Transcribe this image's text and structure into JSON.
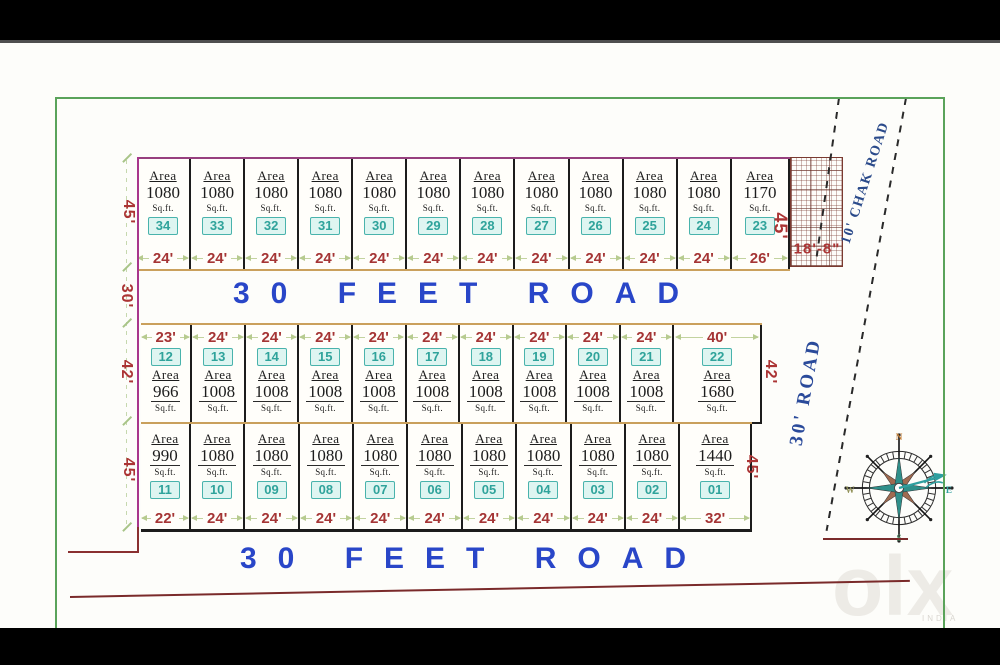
{
  "labels": {
    "area_word": "Area",
    "unit_word": "Sq.ft."
  },
  "roads": {
    "top": "30 FEET ROAD",
    "bottom": "30 FEET ROAD",
    "chak": "10' CHAK ROAD",
    "side": "30' ROAD"
  },
  "dims": {
    "left_top": "45'",
    "left_road": "30'",
    "left_mid": "42'",
    "left_bottom": "45'",
    "right_top": "45'",
    "right_mid": "42'",
    "right_bottom": "45'",
    "hatch_width": "18'-8\""
  },
  "compass": {
    "points": [
      "N",
      "E",
      "S",
      "W"
    ]
  },
  "watermark": {
    "text": "olx",
    "sub": "INDIA"
  },
  "colors": {
    "road_text": "#2946c8",
    "dimension_text": "#ab3434",
    "badge_teal": "#2fa39b",
    "boundary_green": "#5aa35a",
    "boundary_magenta": "#a8368c",
    "row_edge_tan": "#caa05c"
  },
  "rows": {
    "top": {
      "plots": [
        {
          "num": "34",
          "area": "1080",
          "width": "24'",
          "width_ft": 24
        },
        {
          "num": "33",
          "area": "1080",
          "width": "24'",
          "width_ft": 24
        },
        {
          "num": "32",
          "area": "1080",
          "width": "24'",
          "width_ft": 24
        },
        {
          "num": "31",
          "area": "1080",
          "width": "24'",
          "width_ft": 24
        },
        {
          "num": "30",
          "area": "1080",
          "width": "24'",
          "width_ft": 24
        },
        {
          "num": "29",
          "area": "1080",
          "width": "24'",
          "width_ft": 24
        },
        {
          "num": "28",
          "area": "1080",
          "width": "24'",
          "width_ft": 24
        },
        {
          "num": "27",
          "area": "1080",
          "width": "24'",
          "width_ft": 24
        },
        {
          "num": "26",
          "area": "1080",
          "width": "24'",
          "width_ft": 24
        },
        {
          "num": "25",
          "area": "1080",
          "width": "24'",
          "width_ft": 24
        },
        {
          "num": "24",
          "area": "1080",
          "width": "24'",
          "width_ft": 24
        },
        {
          "num": "23",
          "area": "1170",
          "width": "26'",
          "width_ft": 26
        }
      ]
    },
    "middle": {
      "plots": [
        {
          "num": "12",
          "area": "966",
          "width": "23'",
          "width_ft": 23
        },
        {
          "num": "13",
          "area": "1008",
          "width": "24'",
          "width_ft": 24
        },
        {
          "num": "14",
          "area": "1008",
          "width": "24'",
          "width_ft": 24
        },
        {
          "num": "15",
          "area": "1008",
          "width": "24'",
          "width_ft": 24
        },
        {
          "num": "16",
          "area": "1008",
          "width": "24'",
          "width_ft": 24
        },
        {
          "num": "17",
          "area": "1008",
          "width": "24'",
          "width_ft": 24
        },
        {
          "num": "18",
          "area": "1008",
          "width": "24'",
          "width_ft": 24
        },
        {
          "num": "19",
          "area": "1008",
          "width": "24'",
          "width_ft": 24
        },
        {
          "num": "20",
          "area": "1008",
          "width": "24'",
          "width_ft": 24
        },
        {
          "num": "21",
          "area": "1008",
          "width": "24'",
          "width_ft": 24
        },
        {
          "num": "22",
          "area": "1680",
          "width": "40'",
          "width_ft": 40
        }
      ]
    },
    "bottom": {
      "plots": [
        {
          "num": "11",
          "area": "990",
          "width": "22'",
          "width_ft": 22
        },
        {
          "num": "10",
          "area": "1080",
          "width": "24'",
          "width_ft": 24
        },
        {
          "num": "09",
          "area": "1080",
          "width": "24'",
          "width_ft": 24
        },
        {
          "num": "08",
          "area": "1080",
          "width": "24'",
          "width_ft": 24
        },
        {
          "num": "07",
          "area": "1080",
          "width": "24'",
          "width_ft": 24
        },
        {
          "num": "06",
          "area": "1080",
          "width": "24'",
          "width_ft": 24
        },
        {
          "num": "05",
          "area": "1080",
          "width": "24'",
          "width_ft": 24
        },
        {
          "num": "04",
          "area": "1080",
          "width": "24'",
          "width_ft": 24
        },
        {
          "num": "03",
          "area": "1080",
          "width": "24'",
          "width_ft": 24
        },
        {
          "num": "02",
          "area": "1080",
          "width": "24'",
          "width_ft": 24
        },
        {
          "num": "01",
          "area": "1440",
          "width": "32'",
          "width_ft": 32
        }
      ]
    }
  }
}
